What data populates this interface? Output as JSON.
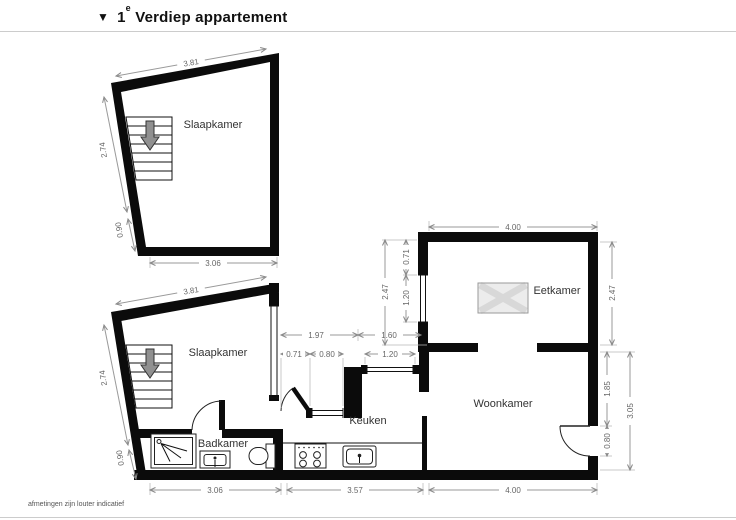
{
  "title": {
    "marker": "▼",
    "floor_number": "1",
    "floor_suffix": "e",
    "text": "Verdiep appartement"
  },
  "footer": {
    "disclaimer": "afmetingen zijn louter indicatief"
  },
  "colors": {
    "walls": "#0b0b0b",
    "dim_lines": "#999999",
    "dim_text": "#666666",
    "room_text": "#333333",
    "stairs_arrow": "#909090"
  },
  "upper_plan": {
    "room": "Slaapkamer",
    "dim_top": "3.81",
    "dim_left": "2.74",
    "dim_left_lower": "0.90",
    "dim_bottom": "3.06"
  },
  "lower_plan": {
    "room_bedroom": "Slaapkamer",
    "room_bathroom": "Badkamer",
    "room_kitchen": "Keuken",
    "room_living": "Woonkamer",
    "room_dining": "Eetkamer",
    "dim_top": "3.81",
    "dim_left": "2.74",
    "dim_left_lower": "0.90",
    "dim_bottom_left": "3.06",
    "dim_bottom_middle": "3.57",
    "dim_bottom_right": "4.00",
    "dim_dining_top": "4.00",
    "dim_dining_right": "2.47",
    "dim_living_right": "1.85",
    "dim_living_door": "0.80",
    "dim_living_right_total": "3.05",
    "dim_court_left": "1.97",
    "dim_court_right": "1.60",
    "dim_court_door": "0.71",
    "dim_court_window": "0.80",
    "dim_kitchen_window": "1.20",
    "dim_dining_left_total": "2.47",
    "dim_dining_left_window": "1.20",
    "dim_dining_left_top": "0.71"
  }
}
